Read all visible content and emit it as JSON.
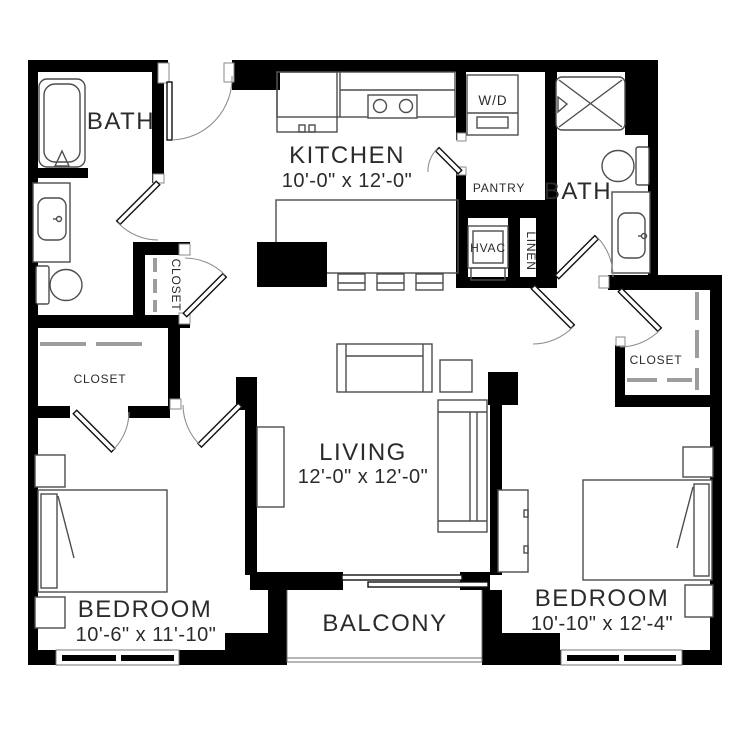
{
  "floorplan": {
    "rooms": {
      "bath_left": {
        "label": "BATH"
      },
      "kitchen": {
        "label": "KITCHEN",
        "dimensions": "10'-0\" x 12'-0\""
      },
      "laundry": {
        "label": "W/D"
      },
      "pantry": {
        "label": "PANTRY"
      },
      "bath_right": {
        "label": "BATH"
      },
      "hvac": {
        "label": "HVAC"
      },
      "linen": {
        "label": "LINEN"
      },
      "closet_hall": {
        "label": "CLOSET"
      },
      "closet_bedroom_left": {
        "label": "CLOSET"
      },
      "closet_bedroom_right": {
        "label": "CLOSET"
      },
      "living": {
        "label": "LIVING",
        "dimensions": "12'-0\" x 12'-0\""
      },
      "bedroom_left": {
        "label": "BEDROOM",
        "dimensions": "10'-6\" x 11'-10\""
      },
      "bedroom_right": {
        "label": "BEDROOM",
        "dimensions": "10'-10\" x 12'-4\""
      },
      "balcony": {
        "label": "BALCONY"
      }
    },
    "colors": {
      "wall": "#000000",
      "fixture_line": "#4d4d4d",
      "dashed_line": "#9d9d9d",
      "text": "#2b2b2b",
      "background": "#ffffff"
    }
  }
}
